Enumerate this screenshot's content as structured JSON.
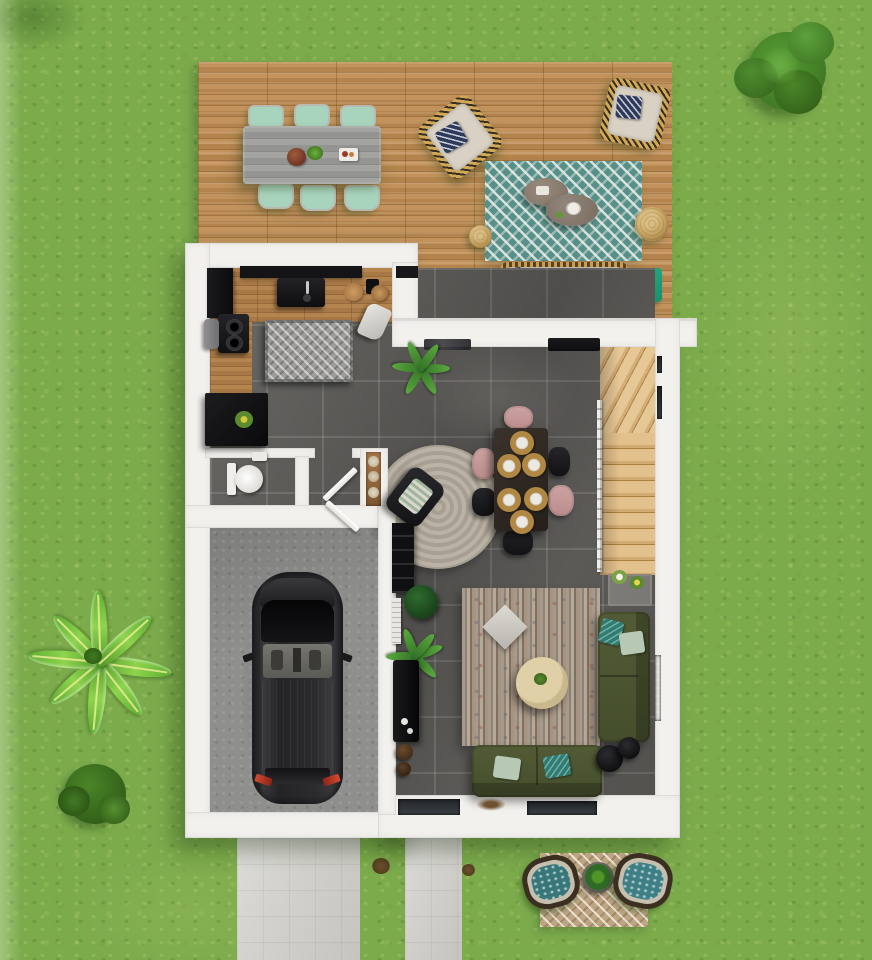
{
  "scene": {
    "kind": "3d-architectural-floor-plan",
    "view": "top-down render, ground floor of a house with garden",
    "width_px": 872,
    "height_px": 960,
    "visible_text": "none"
  },
  "palette": {
    "lawn_green": "#7cab4c",
    "deck_wood": "#b5874f",
    "kitchen_wood": "#aa7c49",
    "interior_tile": "#5b5a57",
    "wall_white": "#f3f1ed",
    "garage_concrete": "#8f8f8d",
    "driveway_paving": "#d1d0cb",
    "stair_wood": "#d9b27e",
    "sofa_olive": "#4a5430",
    "rug_teal": "#57908a",
    "rug_tan": "#bda583",
    "accent_teal_pillow": "#2e7d72",
    "navy_pillow": "#2e3a5c",
    "pink_chair": "#c49a98",
    "dining_table_brown": "#2f2723",
    "car_body": "#222224",
    "taillight_red": "#c23b2a",
    "jute_pouf": "#c3a05e",
    "side_table_green": "#1fa078",
    "plant_bright_green": "#8ed44e",
    "tree_green": "#4a8527"
  },
  "outdoor": {
    "garden_items": [
      "round-tree-top-right",
      "banana-palm-left",
      "shrub-bottom-left",
      "dark-patch-top-left"
    ],
    "deck": {
      "surface": "horizontal wood planks",
      "items": [
        "outdoor-dining-table",
        "mint-dining-chairs x6",
        "centerpiece-bowl",
        "serving-tray",
        "wicker-lounge-chair x2 with navy chevron pillows",
        "teal-chevron-rug",
        "organic-coffee-table x2",
        "jute-pouf-small",
        "jute-pouf-large",
        "outdoor-wicker-sofa with navy pillows",
        "green-side-table with bowl"
      ]
    },
    "front_yard": {
      "items": [
        "driveway-paving",
        "front-walkway-paving",
        "dirt-spot x2",
        "tan-chevron-rug",
        "round-planter-with-plant",
        "hanging-egg-chair x2 with teal cushions"
      ]
    }
  },
  "house": {
    "walls": "white masonry, L-shaped footprint",
    "rooms": [
      {
        "name": "kitchen",
        "floor": "wood",
        "items": [
          "black-wall-counter",
          "black-sink-with-faucet",
          "tall-black-cabinet",
          "coffee-station-with-two-burners",
          "gray-stool",
          "ribbed-gray-island-mat",
          "cutting-board",
          "desk-chair-white",
          "black-speaker",
          "black-sideboard-with-yellow-flowers"
        ]
      },
      {
        "name": "wc",
        "floor": "dark tile",
        "items": [
          "toilet",
          "hand-basin"
        ]
      },
      {
        "name": "hallway",
        "items": [
          "niche-shelf-with-plates",
          "wc-door-open",
          "garage-door-open"
        ]
      },
      {
        "name": "garage",
        "floor": "concrete",
        "items": [
          "black-car"
        ]
      },
      {
        "name": "dining-area",
        "floor": "dark tile",
        "items": [
          "dark-dining-table",
          "place-setting x6",
          "pink-chair x3",
          "black-chair x3",
          "round-beige-rug",
          "black-armchair-with-throw",
          "wall-console-decor",
          "potted-plant"
        ]
      },
      {
        "name": "living-area",
        "floor": "dark tile",
        "items": [
          "striped-multicolor-rug",
          "white-diamond-pillow",
          "round-cream-coffee-table",
          "olive-sofa-vertical with teal pillows",
          "olive-sofa-horizontal with mint+teal pillows",
          "black-nesting-side-tables",
          "flower-console",
          "black-bookshelf",
          "dark-plant-ball",
          "white-radiator-panel",
          "interior-palm",
          "black-tv-cabinet",
          "brown-pouf x2",
          "door-mat",
          "scattered-leaves",
          "bottom-window x2",
          "wall-radiator-right"
        ]
      },
      {
        "name": "staircase",
        "items": [
          "winder-steps",
          "straight-steps",
          "white-balustrade",
          "right-wall-window x2"
        ]
      }
    ]
  }
}
